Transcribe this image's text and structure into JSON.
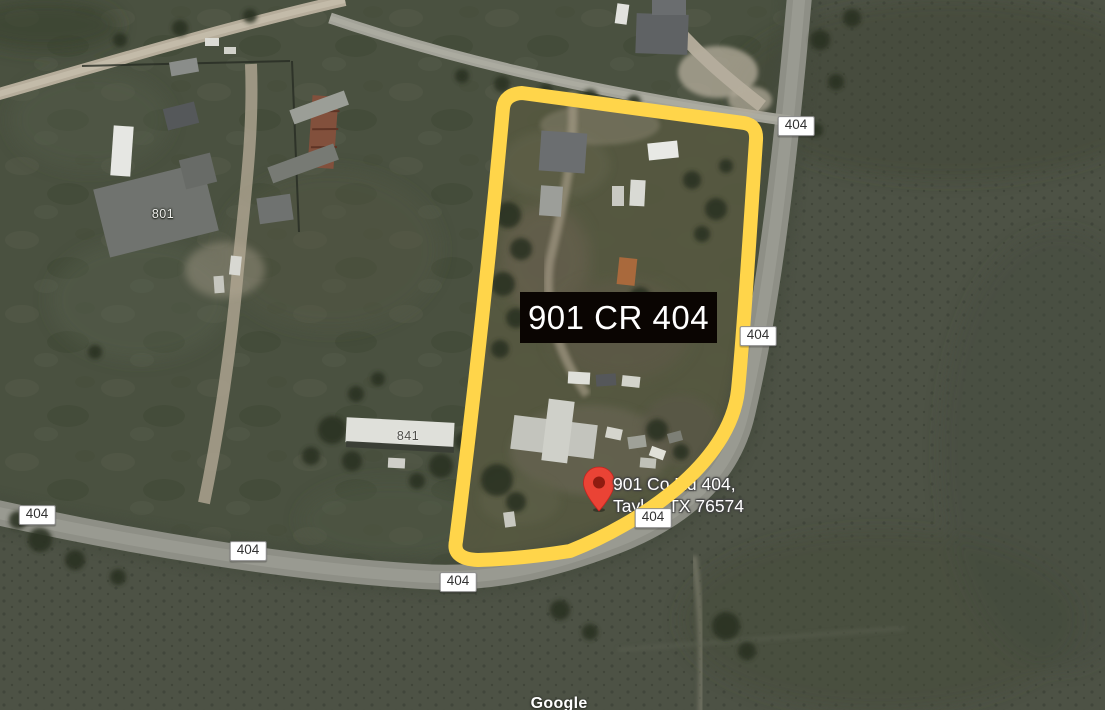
{
  "map": {
    "attribution": "Google",
    "property": {
      "label": "901 CR 404"
    },
    "pin": {
      "address_line1": "901 Co Rd 404,",
      "address_line2": "Taylor, TX 76574"
    },
    "road_badges": [
      {
        "label": "404"
      },
      {
        "label": "404"
      },
      {
        "label": "404"
      },
      {
        "label": "404"
      },
      {
        "label": "404"
      },
      {
        "label": "404"
      }
    ],
    "house_numbers": [
      {
        "label": "801"
      },
      {
        "label": "841"
      }
    ],
    "colors": {
      "property_outline": "#FFD54A",
      "pin_fill": "#EA4335",
      "pin_inner": "#8F1B10",
      "label_background": "#0A0502",
      "label_text": "#FFFFFF",
      "badge_background": "#FFFFFF",
      "badge_border": "#8F8F8F",
      "badge_text": "#333333",
      "field_base": "#4A5140",
      "road_surface": "#8E8F86"
    }
  }
}
